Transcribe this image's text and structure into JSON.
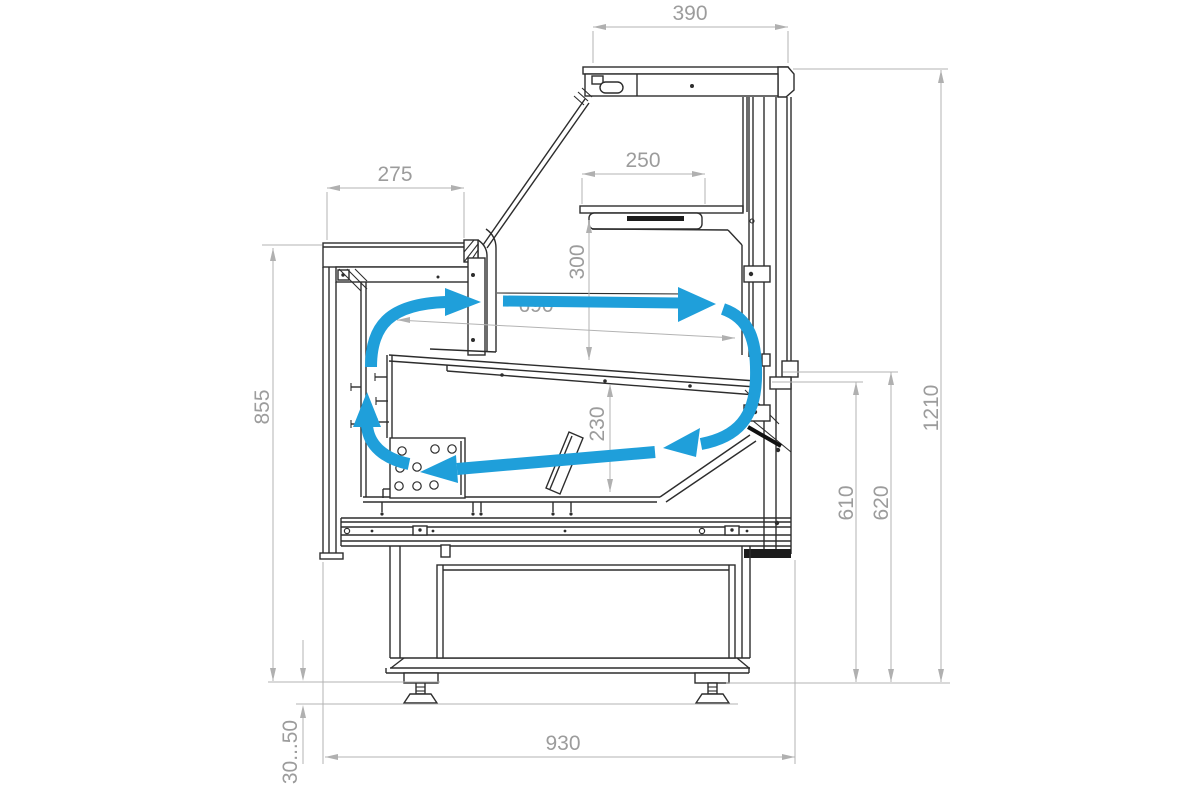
{
  "drawing": {
    "type": "technical-cross-section",
    "subject": "refrigerated serve-over display counter with air circulation loop"
  },
  "colors": {
    "background": "#ffffff",
    "line": "#2d2d2d",
    "dimension_line": "#b3b3b3",
    "dimension_text": "#9c9c9c",
    "airflow": "#1f9fda"
  },
  "dimensions": {
    "canopy_depth": {
      "value": "390",
      "orientation": "horizontal"
    },
    "counter_depth": {
      "value": "275",
      "orientation": "horizontal"
    },
    "shelf_depth": {
      "value": "250",
      "orientation": "horizontal"
    },
    "shelf_clearance": {
      "value": "300",
      "orientation": "vertical"
    },
    "deck_length": {
      "value": "690",
      "orientation": "sloped"
    },
    "well_depth": {
      "value": "230",
      "orientation": "vertical"
    },
    "worktop_height": {
      "value": "855",
      "orientation": "vertical"
    },
    "front_edge_height": {
      "value": "610",
      "orientation": "vertical"
    },
    "rear_ledge_height": {
      "value": "620",
      "orientation": "vertical"
    },
    "overall_height": {
      "value": "1210",
      "orientation": "vertical"
    },
    "base_depth": {
      "value": "930",
      "orientation": "horizontal"
    },
    "leg_adjust_range": {
      "value": "30...50",
      "orientation": "vertical"
    }
  },
  "airflow": {
    "color": "#1f9fda",
    "arrows": [
      {
        "name": "front-outlet-curve",
        "direction": "up-then-right"
      },
      {
        "name": "top-air-curtain",
        "direction": "right"
      },
      {
        "name": "rear-downdraft",
        "direction": "down-then-left"
      },
      {
        "name": "under-deck-return",
        "direction": "left"
      },
      {
        "name": "left-riser",
        "direction": "up"
      }
    ]
  }
}
